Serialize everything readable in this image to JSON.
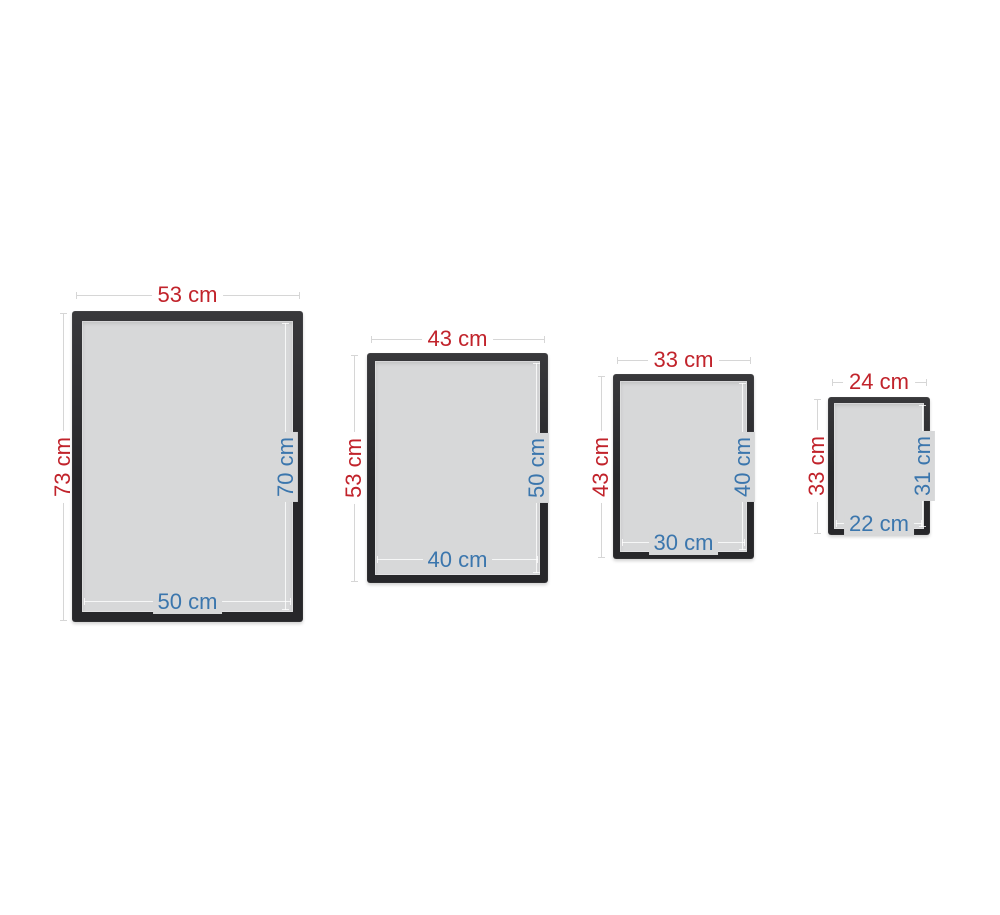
{
  "colors": {
    "outer_dimension": "#c1232b",
    "inner_dimension": "#3b76ad",
    "frame": "#27272a",
    "frame_highlight": "#38383b",
    "glass": "#d7d8d9",
    "dimension_line": "#d6d6d6",
    "background": "#ffffff"
  },
  "frames": [
    {
      "outer_width": "53 cm",
      "outer_height": "73 cm",
      "inner_height": "70 cm",
      "inner_width": "50 cm"
    },
    {
      "outer_width": "43 cm",
      "outer_height": "53 cm",
      "inner_height": "50 cm",
      "inner_width": "40 cm"
    },
    {
      "outer_width": "33 cm",
      "outer_height": "43 cm",
      "inner_height": "40 cm",
      "inner_width": "30 cm"
    },
    {
      "outer_width": "24 cm",
      "outer_height": "33 cm",
      "inner_height": "31 cm",
      "inner_width": "22 cm"
    }
  ]
}
